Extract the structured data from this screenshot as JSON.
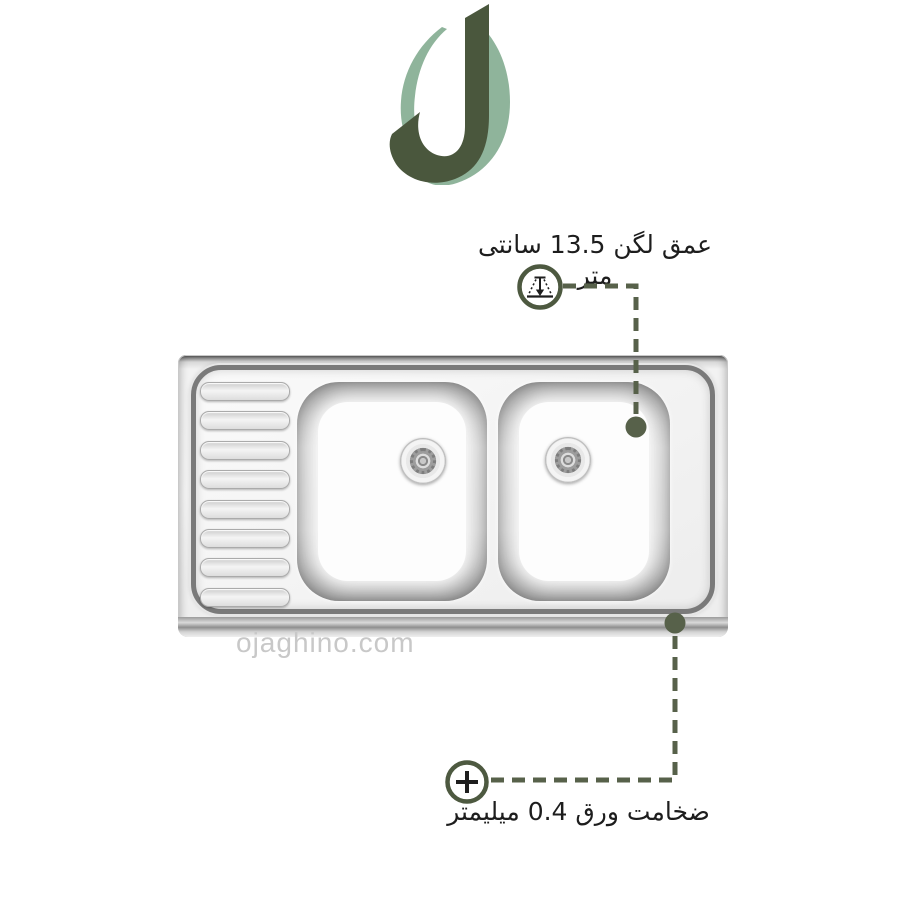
{
  "page": {
    "background": "#ffffff"
  },
  "logo": {
    "name": "ojaghino-j-monogram",
    "dark_green": "#4a573d",
    "light_green": "#8fb49b"
  },
  "annotations": {
    "line_color": "#57614a",
    "marker_color": "#57614a",
    "ring_color": "#4d5940",
    "depth": {
      "label": "عمق لگن 13.5 سانتی متر",
      "icon": "depth-gauge-icon"
    },
    "thickness": {
      "label": "ضخامت ورق 0.4 میلیمتر",
      "icon": "plus-icon"
    }
  },
  "watermark": {
    "text": "ojaghino.com",
    "color": "#c8c8c8"
  },
  "product_image": {
    "type": "stainless-steel-double-bowl-sink-with-drainboard",
    "drainboard_ridges": 8,
    "bowls": 2
  }
}
